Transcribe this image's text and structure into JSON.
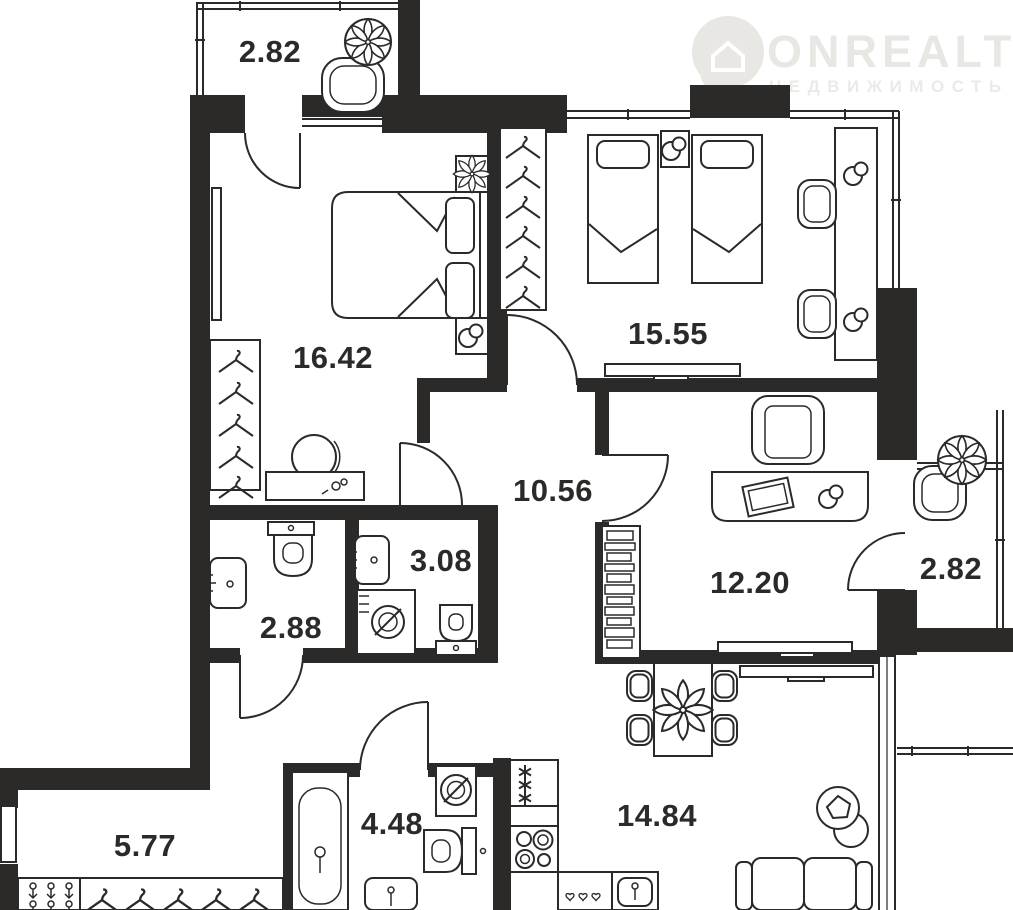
{
  "watermark": {
    "brand": "ONREALT",
    "subtitle": "НЕДВИЖИМОСТЬ",
    "icon": "location-pin-house-icon"
  },
  "rooms": [
    {
      "id": "balcony-top-left",
      "label": "2.82"
    },
    {
      "id": "bedroom-1",
      "label": "16.42"
    },
    {
      "id": "bedroom-2",
      "label": "15.55"
    },
    {
      "id": "hallway",
      "label": "10.56"
    },
    {
      "id": "bathroom-small",
      "label": "3.08"
    },
    {
      "id": "bathroom-2",
      "label": "2.88"
    },
    {
      "id": "study",
      "label": "12.20"
    },
    {
      "id": "balcony-right",
      "label": "2.82"
    },
    {
      "id": "entry-hall",
      "label": "5.77"
    },
    {
      "id": "bathroom-main",
      "label": "4.48"
    },
    {
      "id": "kitchen-living",
      "label": "14.84"
    }
  ],
  "colors": {
    "walls": "#2b2a28",
    "lines": "#2b2a28",
    "background": "#ffffff",
    "watermark": "#e8e7e4",
    "label_text": "#2b2a28"
  }
}
